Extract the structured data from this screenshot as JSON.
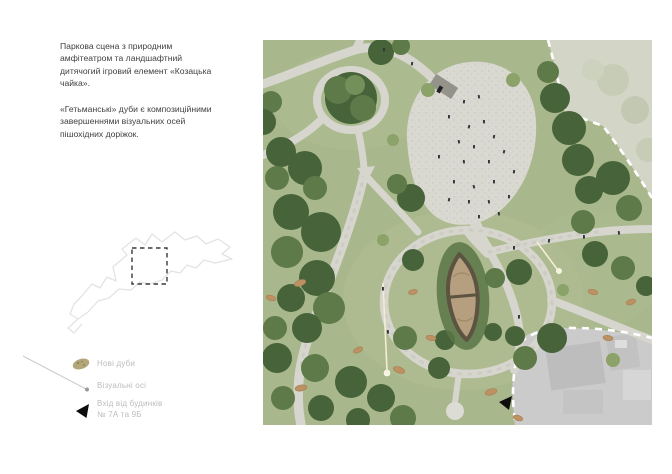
{
  "description": {
    "para1": "Паркова сцена з природним амфітеатром та ландшафтний дитячогий ігровий елемент «Козацька чайка».",
    "para2": "«Гетьманські» дуби є композиційними завершеннями візуальних осей пішохідних доріжок."
  },
  "legend": {
    "items": [
      {
        "icon": "oak-tree-icon",
        "label": "Нові дуби"
      },
      {
        "icon": "visual-axis-icon",
        "label": "Візуальні осі"
      },
      {
        "icon": "entrance-arrow-icon",
        "label": "Вхід від будинків",
        "label2": "№ 7А та 9Б"
      }
    ]
  },
  "colors": {
    "page_background": "#ffffff",
    "body_text": "#3f3f3f",
    "legend_text": "#bcbcbc",
    "lawn_green": "#a9b78c",
    "tree_dark_green": "#47633a",
    "path_gray": "#d7d6ce",
    "plaza_gravel": "#d9d8d1",
    "out_of_site_pale": "#d3d6c7",
    "out_of_site_gray": "#cbcbcb",
    "boundary_dash": "#ffffff",
    "boat_sand": "#b59f7e",
    "boat_rim": "#5c5340",
    "new_oak_tan": "#b3a678",
    "entrance_black": "#0d0d0d",
    "visual_axis": "#f3eed2"
  }
}
